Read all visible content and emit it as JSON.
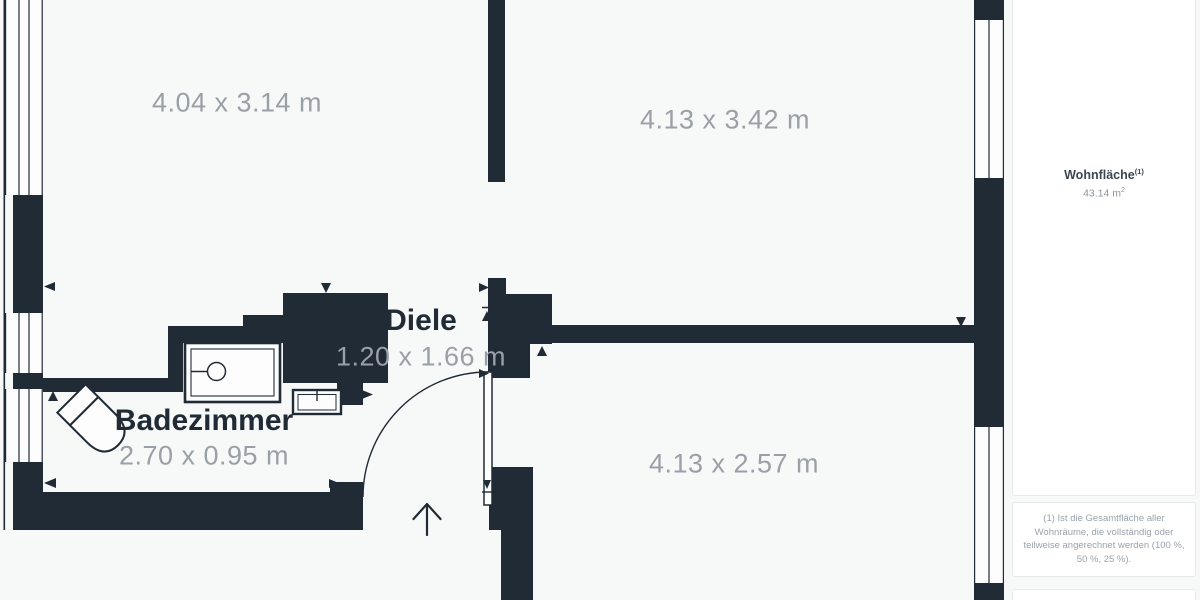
{
  "floorplan": {
    "rooms": [
      {
        "id": "room-top-left",
        "name": "",
        "label": "4.04 x 3.14 m"
      },
      {
        "id": "room-top-right",
        "name": "",
        "label": "4.13 x 3.42 m"
      },
      {
        "id": "diele",
        "name": "Diele",
        "label": "1.20 x 1.66 m"
      },
      {
        "id": "badezimmer",
        "name": "Badezimmer",
        "label": "2.70 x 0.95 m"
      },
      {
        "id": "room-bottom-right",
        "name": "",
        "label": "4.13 x 2.57 m"
      }
    ]
  },
  "sidebar": {
    "area_label": "Wohnfläche",
    "area_label_sup": "(1)",
    "area_value": "43.14 m",
    "area_value_sup": "2",
    "footnote": "(1) Ist die Gesamtfläche aller Wohnräume, die vollständig oder teilweise angerechnet werden (100 %, 50 %, 25 %)."
  },
  "colors": {
    "wall": "#202b36",
    "background": "#f7f8f8",
    "window_fill": "#fdfdfe",
    "dim_text": "#9aa0a7",
    "room_text": "#202b36",
    "card_bg": "#ffffff",
    "card_border": "#e7e9ec",
    "sidebar_title": "#3c4650",
    "sidebar_value": "#8e959d",
    "footnote_text": "#9aa2ac"
  }
}
